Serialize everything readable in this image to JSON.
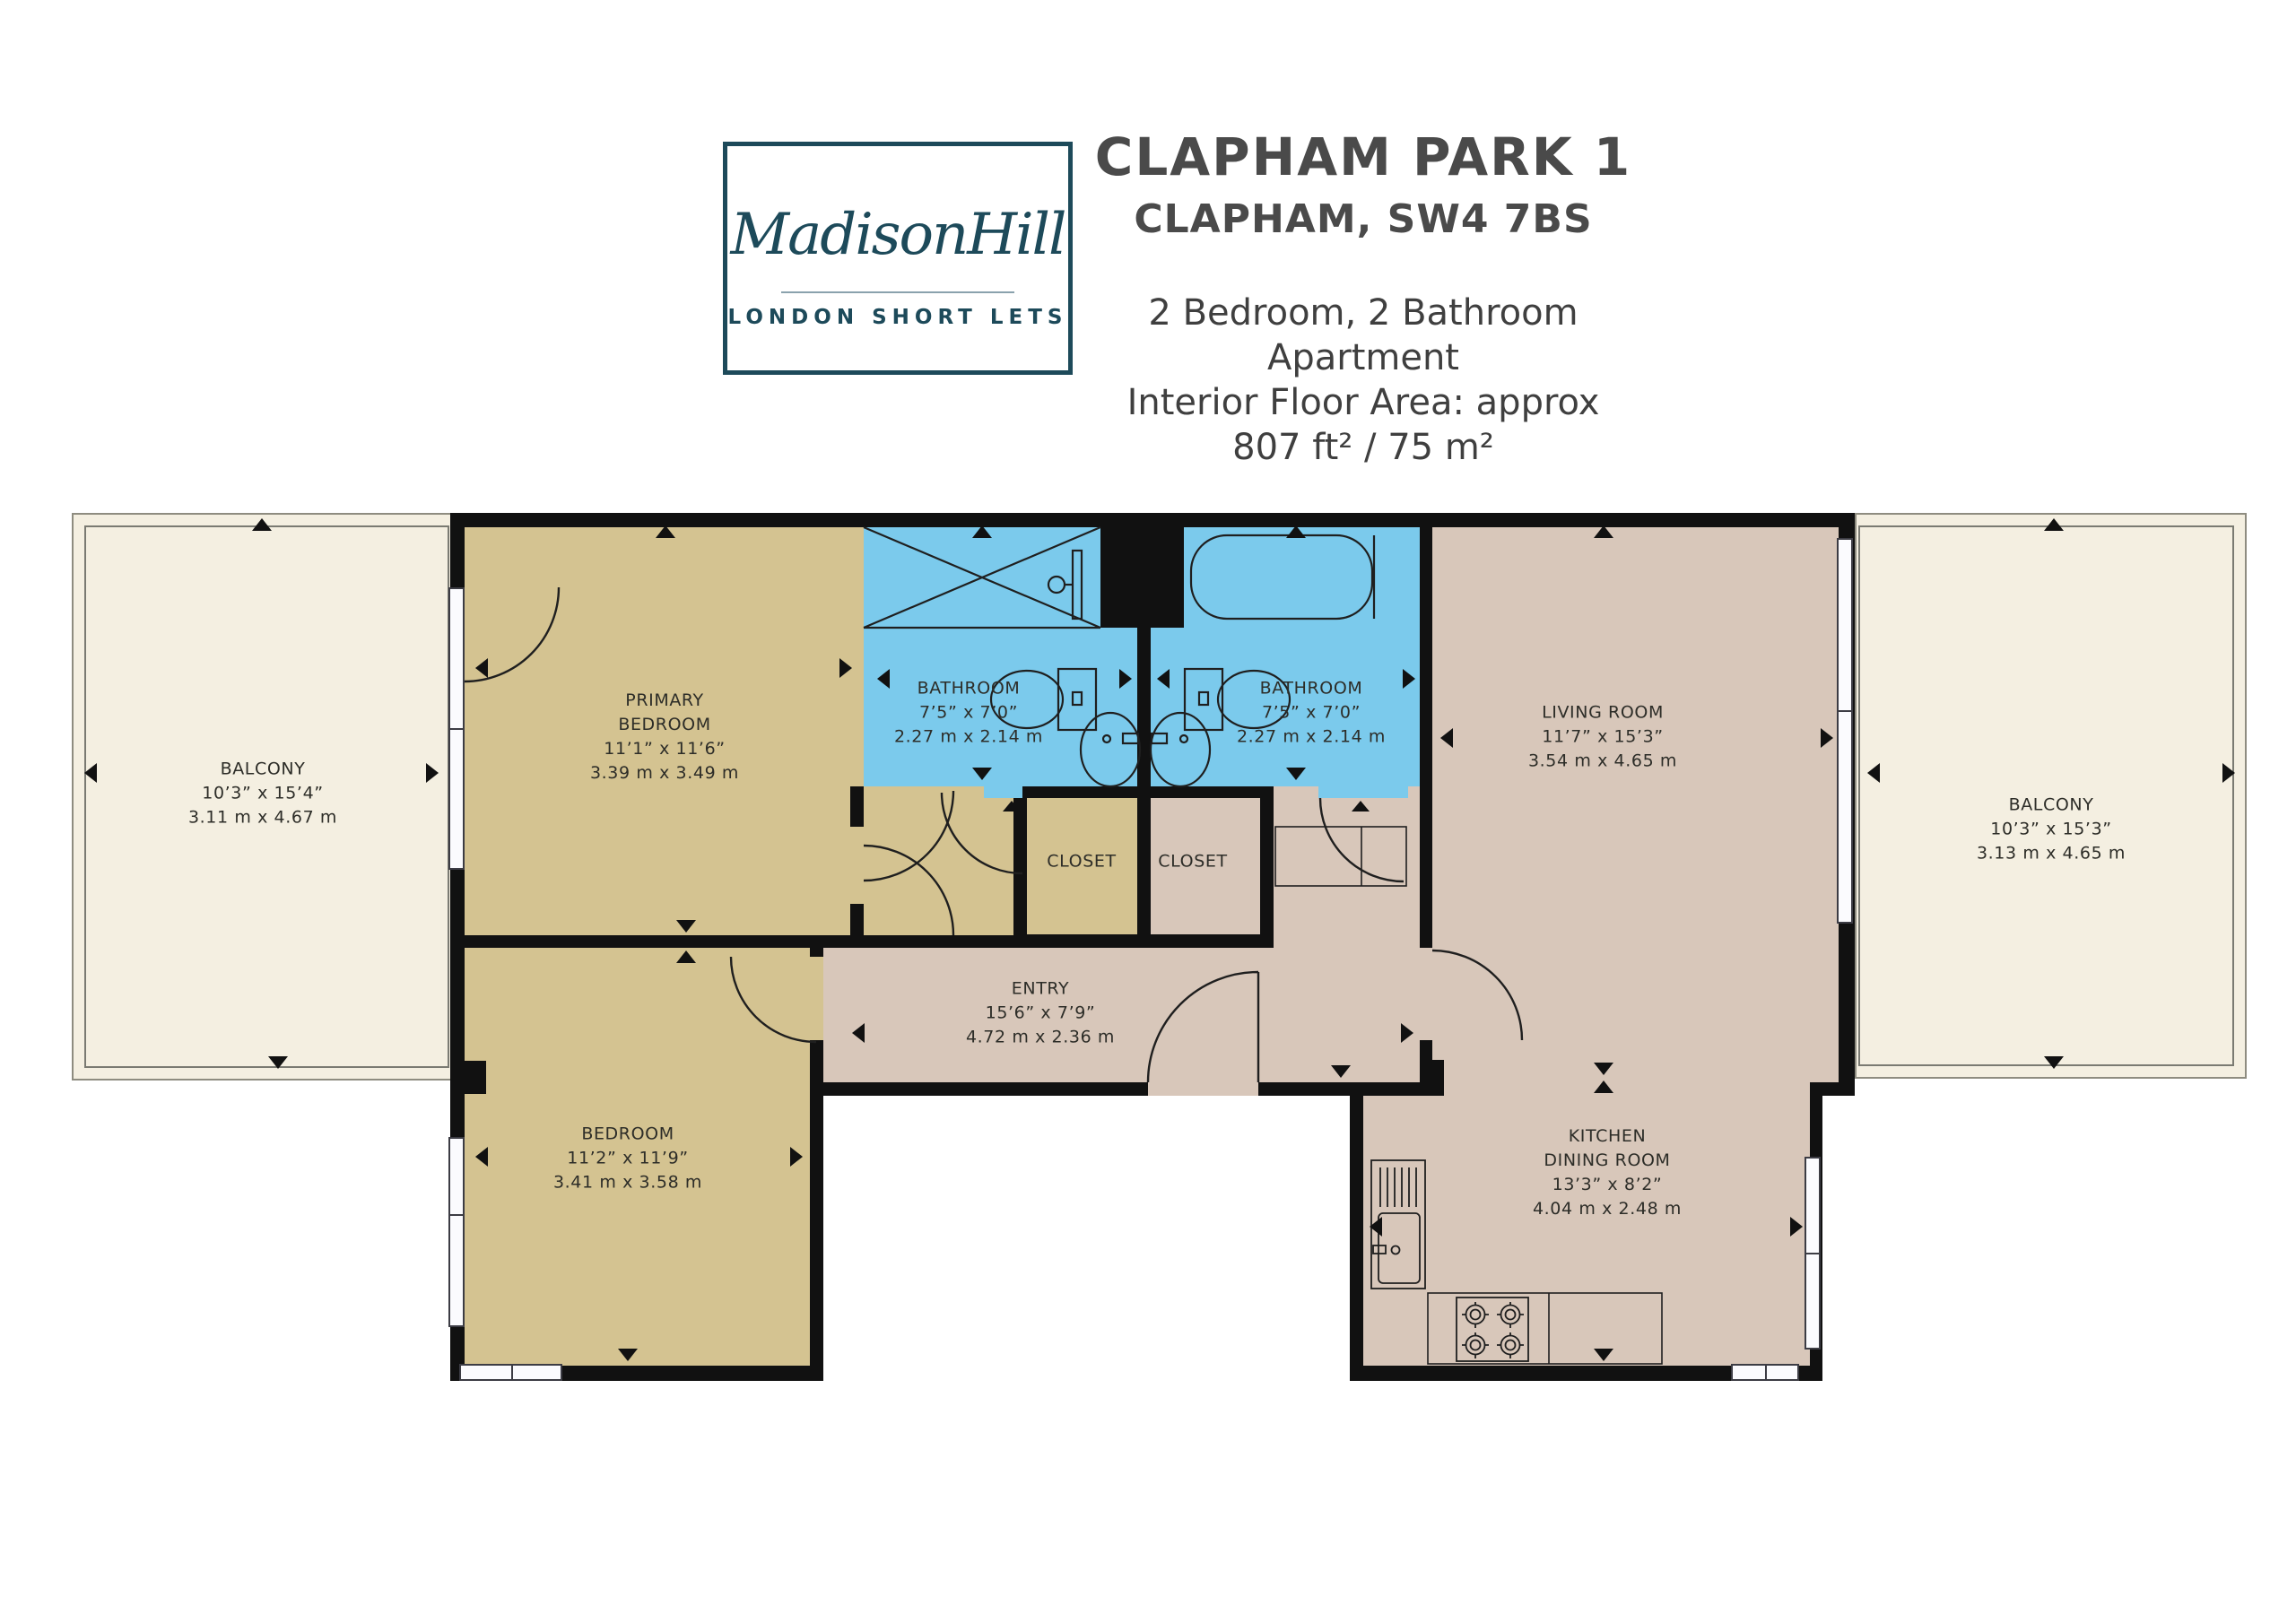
{
  "header": {
    "title": "CLAPHAM PARK 1",
    "subtitle": "CLAPHAM, SW4 7BS",
    "info_line1": "2 Bedroom, 2 Bathroom Apartment",
    "info_line2": "Interior Floor Area: approx 807 ft² / 75 m²"
  },
  "logo": {
    "brand": "MadisonHill",
    "tagline": "LONDON SHORT LETS"
  },
  "rooms": {
    "balcony_left": {
      "name": "BALCONY",
      "dims_ft": "10’3” x 15’4”",
      "dims_m": "3.11 m x 4.67 m"
    },
    "primary_bedroom": {
      "name_line1": "PRIMARY",
      "name_line2": "BEDROOM",
      "dims_ft": "11’1” x 11’6”",
      "dims_m": "3.39 m x 3.49 m"
    },
    "bathroom_1": {
      "name": "BATHROOM",
      "dims_ft": "7’5” x 7’0”",
      "dims_m": "2.27 m x 2.14 m"
    },
    "bathroom_2": {
      "name": "BATHROOM",
      "dims_ft": "7’5” x 7’0”",
      "dims_m": "2.27 m x 2.14 m"
    },
    "living_room": {
      "name": "LIVING ROOM",
      "dims_ft": "11’7” x 15’3”",
      "dims_m": "3.54 m x 4.65 m"
    },
    "balcony_right": {
      "name": "BALCONY",
      "dims_ft": "10’3” x 15’3”",
      "dims_m": "3.13 m x 4.65 m"
    },
    "closet_1": {
      "name": "CLOSET"
    },
    "closet_2": {
      "name": "CLOSET"
    },
    "entry": {
      "name": "ENTRY",
      "dims_ft": "15’6” x 7’9”",
      "dims_m": "4.72 m x 2.36 m"
    },
    "bedroom": {
      "name": "BEDROOM",
      "dims_ft": "11’2” x 11’9”",
      "dims_m": "3.41 m x 3.58 m"
    },
    "kitchen": {
      "name_line1": "KITCHEN",
      "name_line2": "DINING ROOM",
      "dims_ft": "13’3” x 8’2”",
      "dims_m": "4.04 m x 2.48 m"
    }
  },
  "colors": {
    "wall": "#111111",
    "bedroom_fill": "#d4c391",
    "bathroom_fill": "#7bcaec",
    "living_fill": "#d8c7ba",
    "balcony_fill": "#f4efe1",
    "logo_teal": "#1d4a5a",
    "title_gray": "#4a4a4a"
  }
}
